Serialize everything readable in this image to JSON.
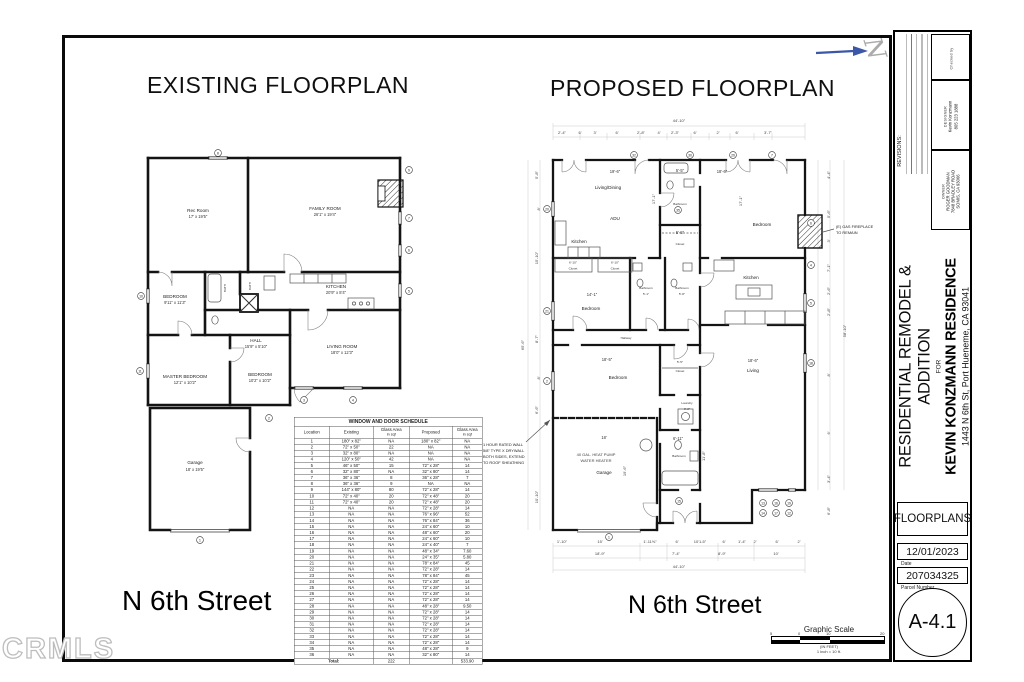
{
  "watermark": "CRMLS",
  "north": {
    "label": "N"
  },
  "existing": {
    "title": "EXISTING FLOORPLAN",
    "street": "N 6th Street",
    "labels": {
      "rec_room": "Rec Room",
      "rec_dim": "17' x 19'5\"",
      "family": "FAMILY ROOM",
      "family_dim": "26'1\" x 19'4\"",
      "bedroom1": "BEDROOM",
      "bedroom1_dim": "9'11\" x 11'3\"",
      "kitchen": "KITCHEN",
      "kitchen_dim": "20'9\" x 8'4\"",
      "hall": "HALL",
      "hall_dim": "15'9\" x 5'10\"",
      "living": "LIVING ROOM",
      "living_dim": "18'0\" x 12'3\"",
      "master": "MASTER BEDROOM",
      "master_dim": "12'1\" x 10'2\"",
      "bedroom2": "BEDROOM",
      "bedroom2_dim": "10'2\" x 10'2\"",
      "garage": "Garage",
      "garage_dim": "18' x 19'5\"",
      "bath1": "BATH",
      "bath2": "BATH"
    },
    "tags": [
      "8",
      "9",
      "7",
      "6",
      "5",
      "10",
      "11",
      "3",
      "4",
      "2",
      "1"
    ]
  },
  "proposed": {
    "title": "PROPOSED FLOORPLAN",
    "street": "N 6th Street",
    "labels": {
      "living_dining_dim": "19'-6\"",
      "living_dining": "Living/Dining",
      "adu": "ADU",
      "kitchen_adu": "Kitchen",
      "vdim_adu": "17'-1\"",
      "bath_top_dim": "5'-5\"",
      "bath_top": "Bathroom",
      "closet_top_dim": "5'-5\"",
      "closet_top": "Closet",
      "bed_ne_dim": "18'-6\"",
      "bed_ne": "Bedroom",
      "vdim_ne": "17'-1\"",
      "kitchen_e": "Kitchen",
      "bed_w_dim": "14'-1\"",
      "bed_w": "Bedroom",
      "bath1": "Bathroom",
      "bath1_dim": "5'-1\"",
      "bath2": "Bathroom",
      "bath2_dim": "5'-8\"",
      "hallway": "Hallway",
      "bed_sw_dim": "18'-5\"",
      "bed_sw": "Bedroom",
      "closet_s_dim": "5'-5\"",
      "closet_s": "Closet",
      "laundry": "Laundry",
      "laundry_dim": "3'-2\"",
      "bath_s_dim": "6'-11\"",
      "bath_s": "Bathroom",
      "bath_s_vdim": "11'-8\"",
      "garage_dim": "18'",
      "garage": "Garage",
      "garage_vdim": "19'-6\"",
      "living_dim": "18'-6\"",
      "living": "Living",
      "closet_a_dim": "6'-10\"",
      "closet_a": "Closet",
      "closet_b_dim": "6'-10\"",
      "closet_b": "Closet"
    },
    "notes": {
      "fireplace1": "(E) GAS FIREPLACE",
      "fireplace2": "TO REMAIN",
      "wall1": "1 HOUR RATED WALL",
      "wall2": "5/8\" TYPE X DRYWALL",
      "wall3": "BOTH SIDES, EXTEND",
      "wall4": "TO ROOF SHEATHING",
      "water1": "40 GAL. HEAT PUMP",
      "water2": "WATER HEATER"
    },
    "dims": {
      "overall_top": "44'-10\"",
      "top": [
        "2'-4\"",
        "6'",
        "3'",
        "6'",
        "2'-8\"",
        "4'",
        "2'-3\"",
        "6'",
        "2'",
        "6'",
        "3'-7\""
      ],
      "bottom1": [
        "1'-10\"",
        "15'",
        "1'-11⅝\"",
        "6'",
        "10'1-5\"",
        "6'",
        "1'-4\"",
        "2'",
        "6'",
        "2'"
      ],
      "bottom2": [
        "18'-9\"",
        "7'-4\"",
        "8'-9\"",
        "10'"
      ],
      "overall_bottom": "44'-10\"",
      "left": [
        "5'-8\"",
        "8'",
        "15'-10\"",
        "65'-6\"",
        "8'-7\"",
        "8'",
        "6'-6\"",
        "10'-10\""
      ],
      "right": [
        "4'-4\"",
        "5'-6\"",
        "3'",
        "7'-1\"",
        "2'-6\"",
        "2'-8\"",
        "58'-10\"",
        "8'",
        "6'",
        "3'-4\"",
        "6'-8\""
      ]
    },
    "tags": [
      "32",
      "30",
      "29",
      "7",
      "20",
      "21",
      "2",
      "6",
      "4",
      "5",
      "18",
      "1",
      "15",
      "13",
      "14",
      "16",
      "17",
      "19",
      "35",
      "12"
    ]
  },
  "schedule": {
    "title": "WINDOW AND DOOR SCHEDULE",
    "headers": [
      {
        "main": "Location",
        "sub": ""
      },
      {
        "main": "Existing",
        "sub": ""
      },
      {
        "main": "Glass Area",
        "sub": "in sqf"
      },
      {
        "main": "Proposed",
        "sub": ""
      },
      {
        "main": "Glass Area",
        "sub": "in sqf"
      }
    ],
    "rows": [
      [
        "1",
        "180\" x 82\"",
        "NA",
        "180\" x 82\"",
        "NA"
      ],
      [
        "2",
        "72\" x 50\"",
        "22",
        "NA",
        "NA"
      ],
      [
        "3",
        "32\" x 80\"",
        "NA",
        "NA",
        "NA"
      ],
      [
        "4",
        "120\" x 50\"",
        "42",
        "NA",
        "NA"
      ],
      [
        "5",
        "46\" x 50\"",
        "15",
        "72\" x 28\"",
        "14"
      ],
      [
        "6",
        "32\" x 80\"",
        "NA",
        "32\" x 80\"",
        "14"
      ],
      [
        "7",
        "36\" x 36\"",
        "8",
        "36\" x 28\"",
        "7"
      ],
      [
        "8",
        "36\" x 36\"",
        "9",
        "NA",
        "NA"
      ],
      [
        "9",
        "144\" x 80\"",
        "80",
        "72\" x 28\"",
        "14"
      ],
      [
        "10",
        "72\" x 40\"",
        "20",
        "72\" x 48\"",
        "20"
      ],
      [
        "11",
        "72\" x 40\"",
        "20",
        "72\" x 48\"",
        "20"
      ],
      [
        "12",
        "NA",
        "NA",
        "72\" x 28\"",
        "14"
      ],
      [
        "13",
        "NA",
        "NA",
        "76\" x 96\"",
        "52"
      ],
      [
        "14",
        "NA",
        "NA",
        "76\" x 84\"",
        "36"
      ],
      [
        "15",
        "NA",
        "NA",
        "24\" x 60\"",
        "10"
      ],
      [
        "16",
        "NA",
        "NA",
        "48\" x 60\"",
        "20"
      ],
      [
        "17",
        "NA",
        "NA",
        "24\" x 60\"",
        "10"
      ],
      [
        "18",
        "NA",
        "NA",
        "24\" x 40\"",
        "7"
      ],
      [
        "19",
        "NA",
        "NA",
        "48\" x 34\"",
        "7.60"
      ],
      [
        "20",
        "NA",
        "NA",
        "24\" x 35\"",
        "5.80"
      ],
      [
        "21",
        "NA",
        "NA",
        "78\" x 84\"",
        "45"
      ],
      [
        "22",
        "NA",
        "NA",
        "72\" x 28\"",
        "14"
      ],
      [
        "23",
        "NA",
        "NA",
        "78\" x 84\"",
        "45"
      ],
      [
        "24",
        "NA",
        "NA",
        "72\" x 28\"",
        "14"
      ],
      [
        "25",
        "NA",
        "NA",
        "72\" x 28\"",
        "14"
      ],
      [
        "26",
        "NA",
        "NA",
        "72\" x 28\"",
        "14"
      ],
      [
        "27",
        "NA",
        "NA",
        "72\" x 28\"",
        "14"
      ],
      [
        "28",
        "NA",
        "NA",
        "48\" x 28\"",
        "9.50"
      ],
      [
        "29",
        "NA",
        "NA",
        "72\" x 28\"",
        "14"
      ],
      [
        "30",
        "NA",
        "NA",
        "72\" x 28\"",
        "14"
      ],
      [
        "31",
        "NA",
        "NA",
        "72\" x 28\"",
        "14"
      ],
      [
        "32",
        "NA",
        "NA",
        "72\" x 28\"",
        "14"
      ],
      [
        "33",
        "NA",
        "NA",
        "72\" x 28\"",
        "14"
      ],
      [
        "34",
        "NA",
        "NA",
        "72\" x 28\"",
        "14"
      ],
      [
        "35",
        "NA",
        "NA",
        "48\" x 28\"",
        "9"
      ],
      [
        "36",
        "NA",
        "NA",
        "32\" x 80\"",
        "14"
      ]
    ],
    "total": {
      "label": "Total:",
      "existing_glass": "222",
      "proposed_glass": "533.90"
    }
  },
  "titleblock": {
    "revisions_label": "REVISIONS:",
    "checked_label": "Checked by",
    "designer_label": "DESIGNER",
    "designer_line1": "Kevin Konzmann",
    "designer_line2": "805 223 1888",
    "owner_label": "OWNER",
    "owner_line1": "ROGER GOODMAN",
    "owner_line2": "7848 BRADLEY ROAD",
    "owner_line3": "SOMIS, CA 93066",
    "project_title": "RESIDENTIAL REMODEL & ADDITION",
    "project_for": "FOR",
    "project_name": "KEVIN KONZMANN RESIDENCE",
    "project_address": "1443 N 6th St, Port Hueneme, CA 93041",
    "sheet_title": "FLOORPLANS",
    "date_value": "12/01/2023",
    "date_label": "Date",
    "parcel_value": "207034325",
    "parcel_label": "Parcel Number",
    "sheet_number": "A-4.1"
  },
  "scale": {
    "title": "Graphic Scale",
    "labels": [
      "5",
      "0",
      "10",
      "20"
    ],
    "note1": "(IN FEET)",
    "note2": "1 inch = 10 ft."
  }
}
